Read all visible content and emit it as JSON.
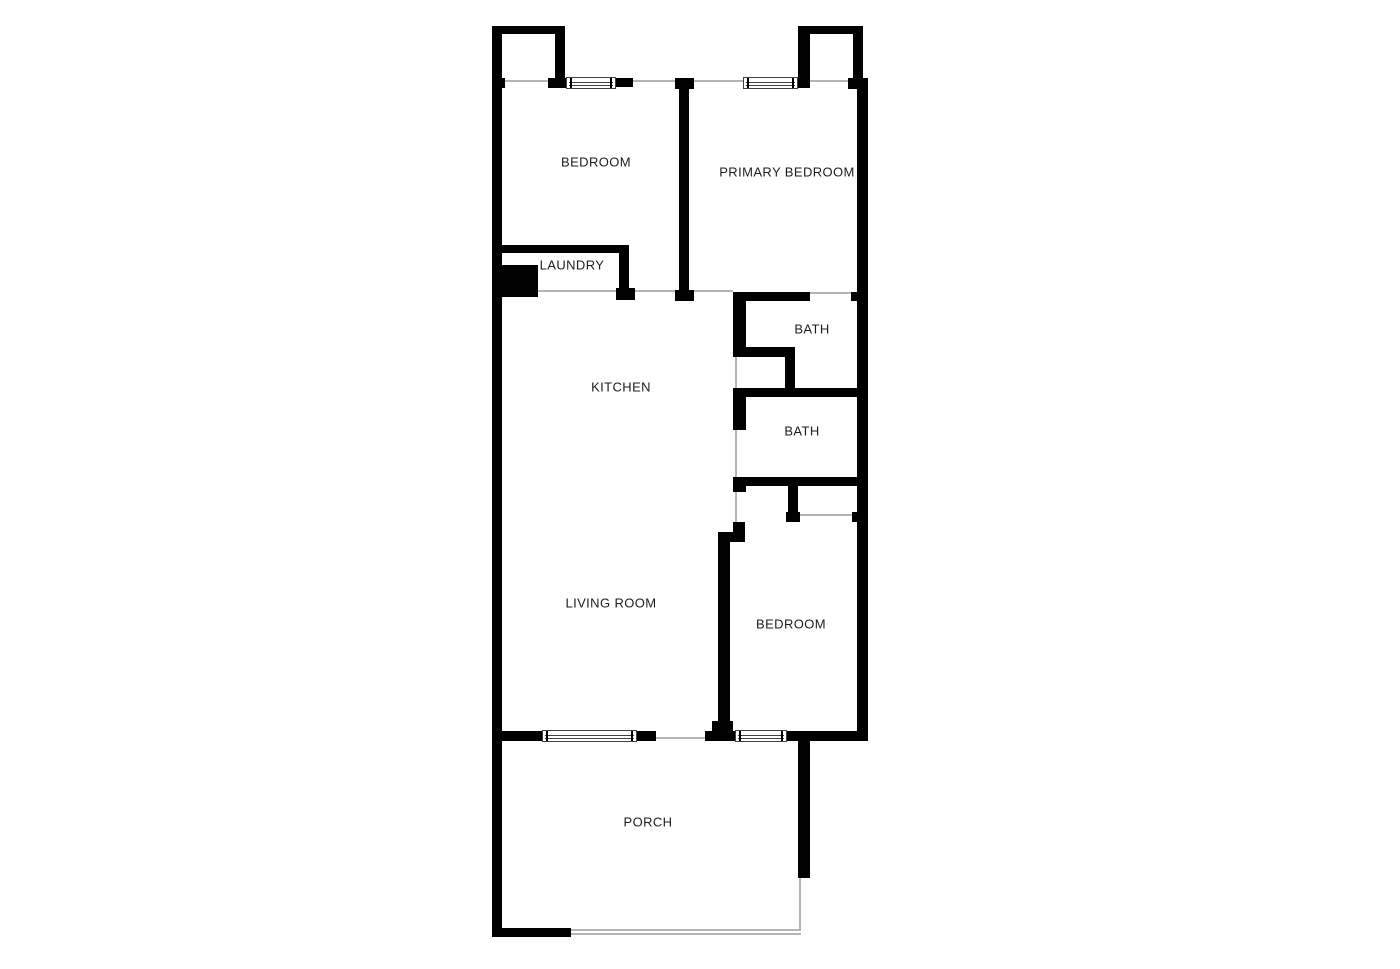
{
  "title": "Floor plan",
  "colors": {
    "wall": "#000000",
    "background": "#ffffff",
    "opening_line": "#b2b5b7",
    "window_line": "#3f4245",
    "label": "#1d1d1f"
  },
  "floorplan": {
    "canvas": {
      "width": 1400,
      "height": 969
    },
    "rooms": [
      {
        "name": "bedroom-1",
        "label": "BEDROOM",
        "x": 596,
        "y": 162
      },
      {
        "name": "primary-bedroom",
        "label": "PRIMARY BEDROOM",
        "x": 787,
        "y": 172
      },
      {
        "name": "laundry",
        "label": "LAUNDRY",
        "x": 572,
        "y": 265
      },
      {
        "name": "kitchen",
        "label": "KITCHEN",
        "x": 621,
        "y": 387
      },
      {
        "name": "bath-1",
        "label": "BATH",
        "x": 812,
        "y": 329
      },
      {
        "name": "bath-2",
        "label": "BATH",
        "x": 802,
        "y": 431
      },
      {
        "name": "living-room",
        "label": "LIVING ROOM",
        "x": 611,
        "y": 603
      },
      {
        "name": "bedroom-3",
        "label": "BEDROOM",
        "x": 791,
        "y": 624
      },
      {
        "name": "porch",
        "label": "PORCH",
        "x": 648,
        "y": 822
      }
    ],
    "walls": [
      {
        "name": "left-exterior-wall",
        "x": 492,
        "y": 26,
        "w": 10,
        "h": 911
      },
      {
        "name": "top-left-closet-top-wall",
        "x": 492,
        "y": 26,
        "w": 73,
        "h": 8
      },
      {
        "name": "top-left-closet-right-wall",
        "x": 555,
        "y": 26,
        "w": 10,
        "h": 56
      },
      {
        "name": "top-left-closet-foot",
        "x": 548,
        "y": 78,
        "w": 19,
        "h": 10
      },
      {
        "name": "top-wall-left-stub",
        "x": 492,
        "y": 78,
        "w": 13,
        "h": 10
      },
      {
        "name": "top-wall-window-right-seg",
        "x": 615,
        "y": 78,
        "w": 18,
        "h": 9
      },
      {
        "name": "divider-top-foot",
        "x": 675,
        "y": 78,
        "w": 19,
        "h": 11
      },
      {
        "name": "bedroom-divider-wall",
        "x": 679,
        "y": 78,
        "w": 10,
        "h": 223
      },
      {
        "name": "divider-bottom-foot",
        "x": 675,
        "y": 290,
        "w": 19,
        "h": 11
      },
      {
        "name": "top-right-closet-top-wall",
        "x": 798,
        "y": 26,
        "w": 65,
        "h": 8
      },
      {
        "name": "top-right-closet-left-wall",
        "x": 798,
        "y": 26,
        "w": 12,
        "h": 62
      },
      {
        "name": "top-right-closet-right-wall",
        "x": 853,
        "y": 26,
        "w": 10,
        "h": 54
      },
      {
        "name": "top-wall-right-stub",
        "x": 848,
        "y": 78,
        "w": 20,
        "h": 11
      },
      {
        "name": "right-exterior-wall",
        "x": 857,
        "y": 78,
        "w": 11,
        "h": 663
      },
      {
        "name": "laundry-top-wall",
        "x": 492,
        "y": 245,
        "w": 136,
        "h": 8
      },
      {
        "name": "laundry-right-wall",
        "x": 619,
        "y": 245,
        "w": 10,
        "h": 47
      },
      {
        "name": "laundry-right-foot",
        "x": 616,
        "y": 288,
        "w": 19,
        "h": 12
      },
      {
        "name": "laundry-unit-block",
        "x": 492,
        "y": 265,
        "w": 46,
        "h": 32
      },
      {
        "name": "bath1-top-wall",
        "x": 733,
        "y": 292,
        "w": 77,
        "h": 9
      },
      {
        "name": "right-wall-stub-mid",
        "x": 851,
        "y": 292,
        "w": 17,
        "h": 9
      },
      {
        "name": "bath1-left-wall",
        "x": 733,
        "y": 292,
        "w": 13,
        "h": 61
      },
      {
        "name": "bath1-bottom-wall",
        "x": 733,
        "y": 347,
        "w": 60,
        "h": 10
      },
      {
        "name": "nook-right-wall",
        "x": 785,
        "y": 347,
        "w": 10,
        "h": 50
      },
      {
        "name": "bath2-top-wall",
        "x": 733,
        "y": 388,
        "w": 135,
        "h": 9
      },
      {
        "name": "bath2-left-wall",
        "x": 733,
        "y": 388,
        "w": 13,
        "h": 42
      },
      {
        "name": "bath2-bottom-wall",
        "x": 733,
        "y": 477,
        "w": 135,
        "h": 9
      },
      {
        "name": "bath2-bottom-left-foot",
        "x": 733,
        "y": 477,
        "w": 13,
        "h": 15
      },
      {
        "name": "bedroom3-closet-left-wall",
        "x": 788,
        "y": 486,
        "w": 10,
        "h": 28
      },
      {
        "name": "bedroom3-closet-left-foot",
        "x": 786,
        "y": 512,
        "w": 14,
        "h": 10
      },
      {
        "name": "bedroom3-closet-right-stub",
        "x": 852,
        "y": 512,
        "w": 10,
        "h": 10
      },
      {
        "name": "bedroom3-jog-vertical",
        "x": 733,
        "y": 522,
        "w": 12,
        "h": 20
      },
      {
        "name": "bedroom3-jog-horizontal",
        "x": 718,
        "y": 532,
        "w": 27,
        "h": 10
      },
      {
        "name": "bedroom3-left-wall",
        "x": 718,
        "y": 532,
        "w": 12,
        "h": 200
      },
      {
        "name": "bedroom3-left-wall-foot",
        "x": 712,
        "y": 721,
        "w": 21,
        "h": 11
      },
      {
        "name": "bottom-wall-seg-a",
        "x": 492,
        "y": 731,
        "w": 50,
        "h": 10
      },
      {
        "name": "bottom-wall-seg-b",
        "x": 637,
        "y": 731,
        "w": 19,
        "h": 10
      },
      {
        "name": "bottom-wall-seg-c",
        "x": 705,
        "y": 731,
        "w": 30,
        "h": 10
      },
      {
        "name": "bottom-wall-seg-d",
        "x": 787,
        "y": 731,
        "w": 81,
        "h": 10
      },
      {
        "name": "porch-right-wall",
        "x": 798,
        "y": 740,
        "w": 12,
        "h": 138
      },
      {
        "name": "porch-bottom-wall",
        "x": 492,
        "y": 928,
        "w": 79,
        "h": 9
      }
    ],
    "openings": [
      {
        "name": "closet-opening-left",
        "x": 504,
        "y": 80,
        "w": 44,
        "h": 2
      },
      {
        "name": "top-opening-left-of-divider",
        "x": 633,
        "y": 80,
        "w": 44,
        "h": 2
      },
      {
        "name": "top-opening-right-of-divider",
        "x": 693,
        "y": 80,
        "w": 50,
        "h": 2
      },
      {
        "name": "closet-opening-right",
        "x": 810,
        "y": 80,
        "w": 38,
        "h": 2
      },
      {
        "name": "hall-boundary-line",
        "x": 538,
        "y": 290,
        "w": 195,
        "h": 2
      },
      {
        "name": "primary-bath-door-opening",
        "x": 810,
        "y": 292,
        "w": 41,
        "h": 2
      },
      {
        "name": "linen-nook-opening",
        "x": 735,
        "y": 353,
        "w": 2,
        "h": 36
      },
      {
        "name": "bath2-door-opening",
        "x": 735,
        "y": 430,
        "w": 2,
        "h": 47
      },
      {
        "name": "bedroom3-door-boundary",
        "x": 735,
        "y": 492,
        "w": 2,
        "h": 40
      },
      {
        "name": "bedroom3-closet-opening",
        "x": 798,
        "y": 514,
        "w": 54,
        "h": 2
      },
      {
        "name": "porch-door-opening",
        "x": 656,
        "y": 737,
        "w": 49,
        "h": 2
      },
      {
        "name": "porch-screen-right",
        "x": 799,
        "y": 878,
        "w": 2,
        "h": 53
      },
      {
        "name": "porch-screen-bottom-outer",
        "x": 571,
        "y": 929,
        "w": 230,
        "h": 2
      },
      {
        "name": "porch-screen-bottom-inner",
        "x": 571,
        "y": 933,
        "w": 230,
        "h": 2
      }
    ],
    "windows": [
      {
        "name": "window-bedroom-top",
        "x": 566,
        "y": 77,
        "w": 50,
        "h": 12
      },
      {
        "name": "window-primary-bedroom",
        "x": 743,
        "y": 77,
        "w": 55,
        "h": 12
      },
      {
        "name": "window-living-room",
        "x": 542,
        "y": 730,
        "w": 95,
        "h": 12
      },
      {
        "name": "window-bedroom-bottom",
        "x": 735,
        "y": 730,
        "w": 52,
        "h": 12
      }
    ]
  }
}
